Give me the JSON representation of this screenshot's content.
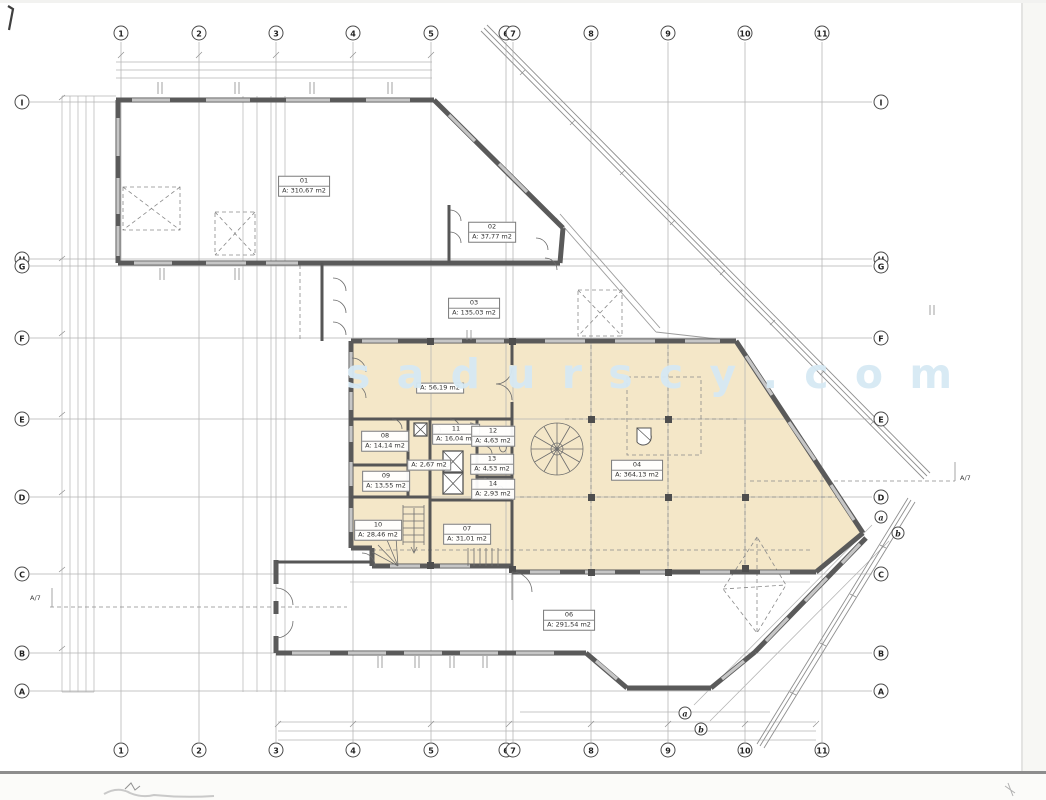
{
  "watermark": "s a d u r s c y . c o m",
  "colors": {
    "highlight": "#f4e7c8",
    "wall": "#5a5a5a",
    "grid_line": "#b3b3b3",
    "watermark_blue": "#d6e9f4"
  },
  "grid": {
    "columns": [
      {
        "label": "1",
        "x": 121
      },
      {
        "label": "2",
        "x": 199
      },
      {
        "label": "3",
        "x": 276
      },
      {
        "label": "4",
        "x": 353
      },
      {
        "label": "5",
        "x": 431
      },
      {
        "label": "6",
        "x": 506
      },
      {
        "label": "7",
        "x": 513
      },
      {
        "label": "8",
        "x": 591
      },
      {
        "label": "9",
        "x": 668
      },
      {
        "label": "10",
        "x": 745
      },
      {
        "label": "11",
        "x": 822
      }
    ],
    "rows": [
      {
        "label": "I",
        "y": 102
      },
      {
        "label": "H",
        "y": 259
      },
      {
        "label": "G",
        "y": 266
      },
      {
        "label": "F",
        "y": 338
      },
      {
        "label": "E",
        "y": 419
      },
      {
        "label": "D",
        "y": 497
      },
      {
        "label": "C",
        "y": 574
      },
      {
        "label": "B",
        "y": 653
      },
      {
        "label": "A",
        "y": 691
      }
    ],
    "diag_axes": [
      {
        "label": "a",
        "line": [
          872,
          525,
          694,
          705
        ],
        "ends": [
          [
            881,
            517
          ],
          [
            685,
            713
          ]
        ]
      },
      {
        "label": "b",
        "line": [
          889,
          541,
          710,
          721
        ],
        "ends": [
          [
            898,
            533
          ],
          [
            701,
            729
          ]
        ]
      }
    ]
  },
  "section_markers": [
    {
      "label": "A/7",
      "x": 30,
      "y": 594
    },
    {
      "label": "A/7",
      "x": 960,
      "y": 474
    }
  ],
  "rooms": [
    {
      "number": "01",
      "area": "A: 310,67 m2",
      "x": 304,
      "y": 186
    },
    {
      "number": "02",
      "area": "A: 37,77 m2",
      "x": 492,
      "y": 232
    },
    {
      "number": "03",
      "area": "A: 135,03 m2",
      "x": 474,
      "y": 308
    },
    {
      "number": "",
      "area": "A: 56,19 m2",
      "x": 440,
      "y": 388
    },
    {
      "number": "08",
      "area": "A: 14,14 m2",
      "x": 385,
      "y": 441
    },
    {
      "number": "11",
      "area": "A: 16,04 m2",
      "x": 456,
      "y": 434
    },
    {
      "number": "12",
      "area": "A: 4,63 m2",
      "x": 493,
      "y": 436
    },
    {
      "number": "",
      "area": "A: 2,67 m2",
      "x": 429,
      "y": 465
    },
    {
      "number": "13",
      "area": "A: 4,53 m2",
      "x": 492,
      "y": 464
    },
    {
      "number": "14",
      "area": "A: 2,93 m2",
      "x": 493,
      "y": 489
    },
    {
      "number": "09",
      "area": "A: 13,55 m2",
      "x": 386,
      "y": 481
    },
    {
      "number": "10",
      "area": "A: 28,46 m2",
      "x": 378,
      "y": 530
    },
    {
      "number": "07",
      "area": "A: 31,01 m2",
      "x": 467,
      "y": 534
    },
    {
      "number": "04",
      "area": "A: 364,13 m2",
      "x": 637,
      "y": 470
    },
    {
      "number": "06",
      "area": "A: 291,54 m2",
      "x": 569,
      "y": 620
    }
  ]
}
